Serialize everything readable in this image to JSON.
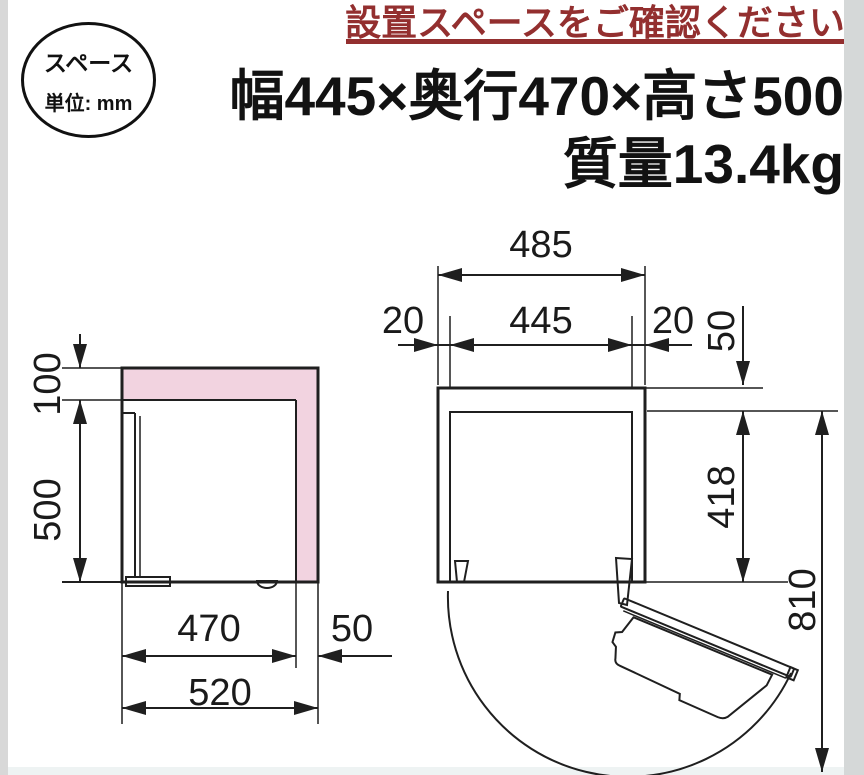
{
  "colors": {
    "accent_red": "#932f2f",
    "pink": "#f2d3e0",
    "line": "#1f1f1f",
    "edge_strip": "#d8d8d8"
  },
  "badge": {
    "line1": "スペース",
    "line2": "単位: mm"
  },
  "header": {
    "title": "設置スペースをご確認ください"
  },
  "spec": {
    "dimensions": "幅445×奥行470×高さ500",
    "weight": "質量13.4kg"
  },
  "side_view": {
    "top_clearance": "100",
    "body_height": "500",
    "body_depth": "470",
    "rear_clearance": "50",
    "total_depth": "520"
  },
  "top_view": {
    "total_width": "485",
    "body_width": "445",
    "left_clearance": "20",
    "right_clearance": "20",
    "rear_clearance": "50",
    "body_depth": "418",
    "door_open_depth": "810"
  }
}
